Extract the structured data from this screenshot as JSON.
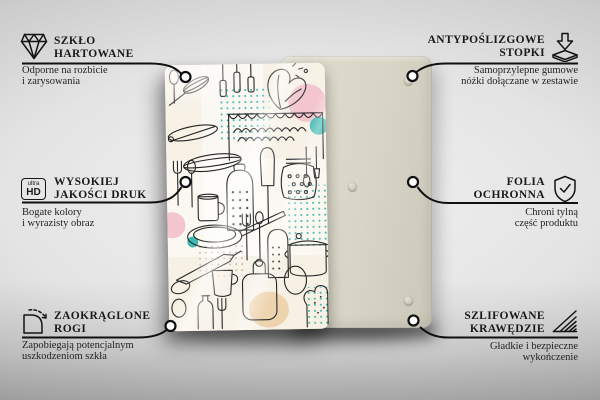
{
  "page": {
    "kind": "product-feature-infographic",
    "product": "glass kitchen board shown from front (printed side) and back (protective side)"
  },
  "features": [
    {
      "id": "szklo-hartowane",
      "side": "left",
      "icon": "diamond-icon",
      "title_lines": [
        "SZKŁO",
        "HARTOWANE"
      ],
      "desc_lines": [
        "Odporne na rozbicie",
        "i zarysowania"
      ]
    },
    {
      "id": "wysokiej-jakosci-druk",
      "side": "left",
      "icon": "ultra-hd-icon",
      "icon_text": {
        "top": "ultra",
        "bottom": "HD"
      },
      "title_lines": [
        "WYSOKIEJ",
        "JAKOŚCI DRUK"
      ],
      "desc_lines": [
        "Bogate kolory",
        "i wyrazisty obraz"
      ]
    },
    {
      "id": "zaokraglone-rogi",
      "side": "left",
      "icon": "rounded-corner-icon",
      "title_lines": [
        "ZAOKRĄGLONE",
        "ROGI"
      ],
      "desc_lines": [
        "Zapobiegają potencjalnym",
        "uszkodzeniom szkła"
      ]
    },
    {
      "id": "antyposlizgowe-stopki",
      "side": "right",
      "icon": "anti-slip-pad-icon",
      "title_lines": [
        "ANTYPOŚLIZGOWE",
        "STOPKI"
      ],
      "desc_lines": [
        "Samoprzylepne gumowe",
        "nóżki dołączane w zestawie"
      ]
    },
    {
      "id": "folia-ochronna",
      "side": "right",
      "icon": "shield-check-icon",
      "title_lines": [
        "FOLIA",
        "OCHRONNA"
      ],
      "desc_lines": [
        "Chroni tylną",
        "część produktu"
      ]
    },
    {
      "id": "szlifowane-krawedzie",
      "side": "right",
      "icon": "ground-edges-icon",
      "title_lines": [
        "SZLIFOWANE",
        "KRAWĘDZIE"
      ],
      "desc_lines": [
        "Gładkie i bezpieczne",
        "wykończenie"
      ]
    }
  ],
  "colors": {
    "callout_line": "#101010",
    "text": "#1a1a1a",
    "back_panel": "#d8d5c6",
    "glass_base": "#fbf8f1",
    "accent_teal": "#3fb8b2",
    "accent_pink": "#f3c5ce",
    "accent_tan": "#ecd0a8",
    "background_light": "#f1f1f1",
    "background_dark": "#9b9b9b"
  }
}
